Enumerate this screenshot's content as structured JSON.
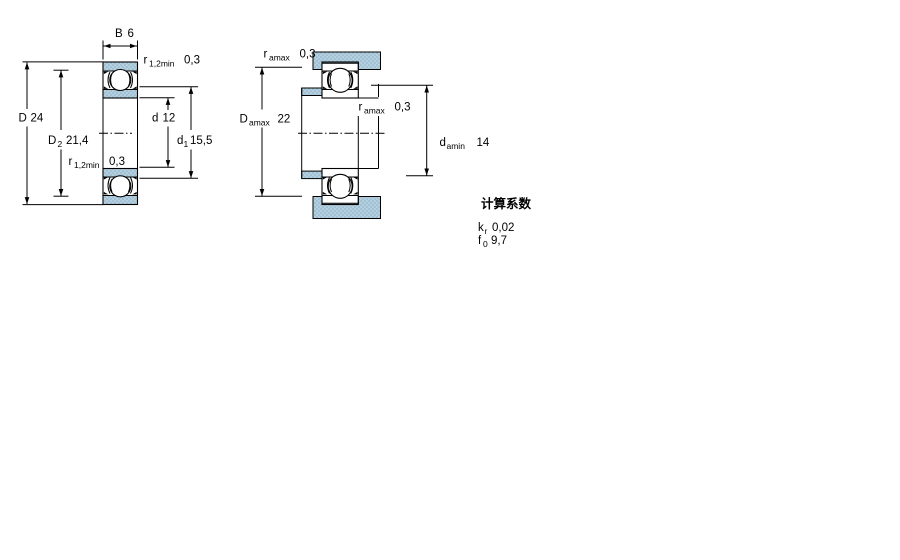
{
  "drawing_type": "bearing-dimension-diagram",
  "colors": {
    "section_fill": "#b5cfdf",
    "section_dot": "#8ab0c8",
    "line": "#000000",
    "background": "#ffffff"
  },
  "left": {
    "b": {
      "sym": "B",
      "val": "6"
    },
    "r_top": {
      "sym": "r",
      "sub": "1,2min",
      "val": "0,3"
    },
    "D": {
      "sym": "D",
      "val": "24"
    },
    "D2": {
      "sym": "D",
      "sub": "2",
      "val": "21,4"
    },
    "r_bot": {
      "sym": "r",
      "sub": "1,2min",
      "val": "0,3"
    },
    "d": {
      "sym": "d",
      "val": "12"
    },
    "d1": {
      "sym": "d",
      "sub": "1",
      "val": "15,5"
    }
  },
  "right": {
    "r_top": {
      "sym": "r",
      "sub": "amax",
      "val": "0,3"
    },
    "Damax": {
      "sym": "D",
      "sub": "amax",
      "val": "22"
    },
    "r_mid": {
      "sym": "r",
      "sub": "amax",
      "val": "0,3"
    },
    "damin": {
      "sym": "d",
      "sub": "amin",
      "val": "14"
    }
  },
  "factors": {
    "title": "计算系数",
    "kr": {
      "sym": "k",
      "sub": "r",
      "val": "0,02"
    },
    "f0": {
      "sym": "f",
      "sub": "0",
      "val": "9,7"
    }
  }
}
